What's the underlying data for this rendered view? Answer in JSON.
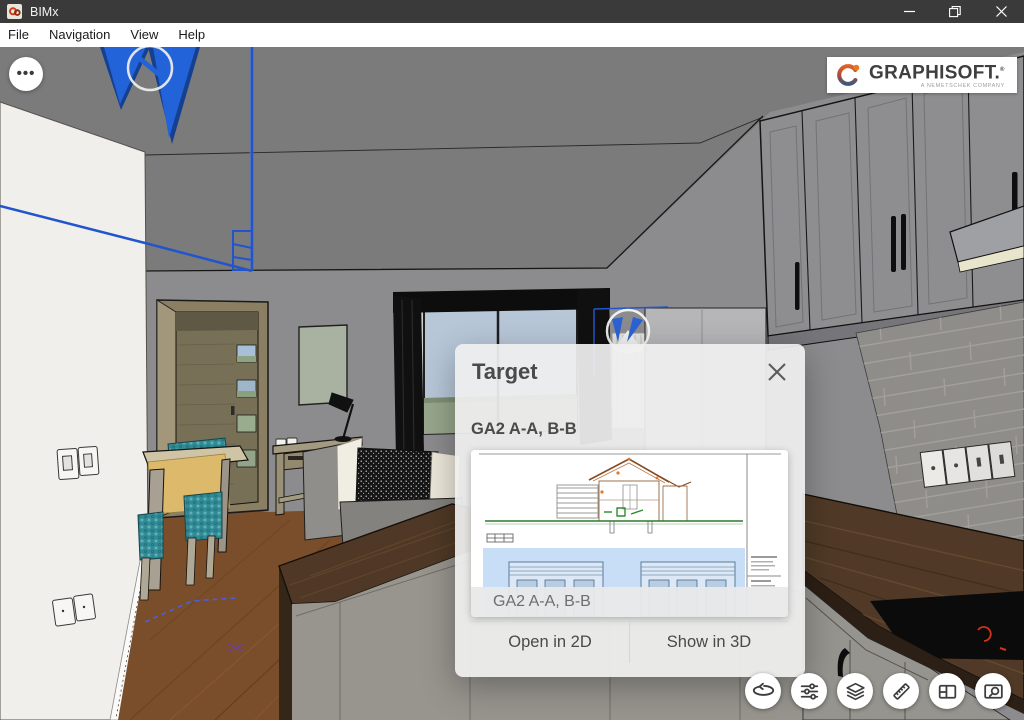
{
  "window": {
    "app_title": "BIMx"
  },
  "menu_bar": {
    "items": [
      "File",
      "Navigation",
      "View",
      "Help"
    ]
  },
  "viewport": {
    "more_options_glyph": "•••",
    "scene_description": "3D interior model: living-dining room with kitchen, section markers in blue"
  },
  "branding": {
    "name": "GRAPHISOFT.",
    "reg_mark": "®",
    "tagline": "A NEMETSCHEK COMPANY"
  },
  "dialog": {
    "title": "Target",
    "item_title": "GA2 A-A, B-B",
    "thumbnail_caption": "GA2 A-A, B-B",
    "open_2d_label": "Open in 2D",
    "show_3d_label": "Show in 3D"
  },
  "toolbar": {
    "icons": [
      "orbit",
      "filter-sliders",
      "layers",
      "ruler",
      "layout-sheet",
      "preview-search"
    ]
  },
  "colors": {
    "titlebar": "#3a3a3a",
    "section_marker_blue": "#2363d9",
    "cooktop_indicator_red": "#d4321a",
    "logo_orange": "#e87722",
    "logo_slate": "#3d5a80",
    "dialog_bg": "rgba(239,239,239,0.93)"
  }
}
